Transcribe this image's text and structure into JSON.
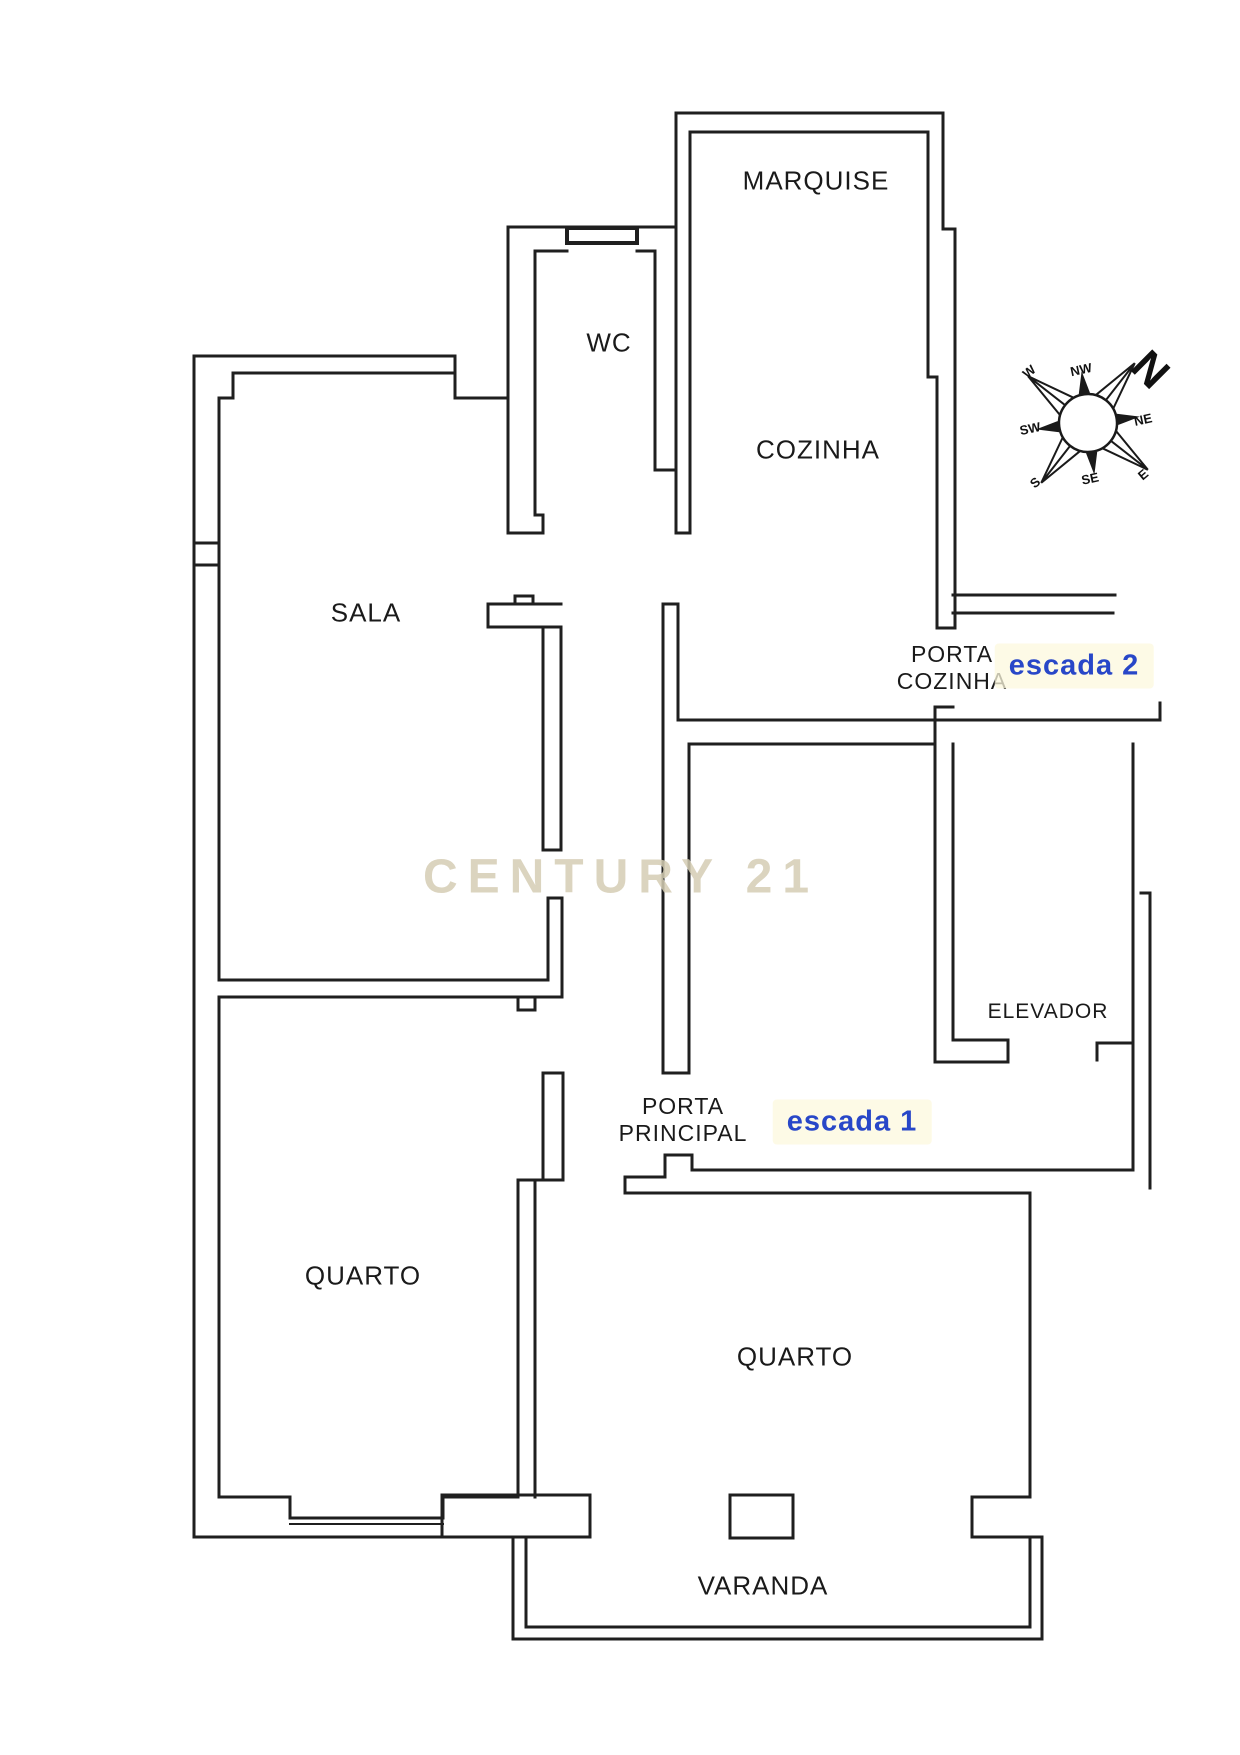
{
  "plan": {
    "watermark": "CENTURY 21",
    "rooms": {
      "marquise": "MARQUISE",
      "wc": "WC",
      "cozinha": "COZINHA",
      "sala": "SALA",
      "elevador": "ELEVADOR",
      "quarto_left": "QUARTO",
      "quarto_right": "QUARTO",
      "varanda": "VARANDA"
    },
    "doors": {
      "porta_cozinha_line1": "PORTA",
      "porta_cozinha_line2": "COZINHA",
      "porta_principal_line1": "PORTA",
      "porta_principal_line2": "PRINCIPAL"
    },
    "stairs": {
      "escada2": "escada 2",
      "escada1": "escada 1"
    },
    "compass": {
      "n": "N",
      "ne": "NE",
      "e": "E",
      "se": "SE",
      "s": "S",
      "sw": "SW",
      "w": "W",
      "nw": "NW"
    },
    "colors": {
      "wall": "#1f1f1f",
      "label": "#1a1a1a",
      "stairs_blue": "#2847c8",
      "watermark": "#d5cdb4"
    }
  }
}
